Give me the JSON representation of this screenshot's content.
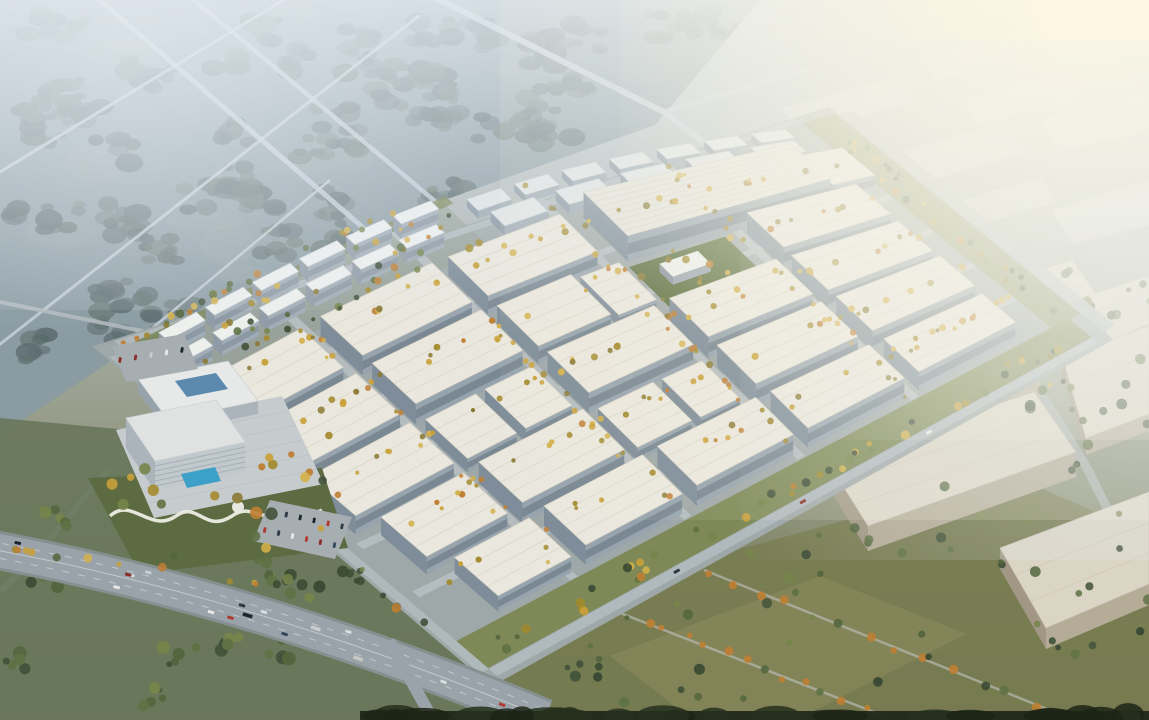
{
  "meta": {
    "description": "Aerial architectural rendering of a large industrial logistics park: grid of white warehouses with tree-lined streets, residential slab blocks and hotel amenity zone at the west, misty forest with country roads to the north-west, hazy distant warehouse district to the north-east, olive fields, scattered woods and a highway in the foreground",
    "lighting": "hazy daylight, sun glow from upper right"
  },
  "palette": {
    "sky_stops": [
      [
        0,
        "#c1cbd2"
      ],
      [
        0.3,
        "#afb7b6"
      ],
      [
        0.55,
        "#9ba190"
      ],
      [
        0.75,
        "#84896c"
      ],
      [
        1,
        "#6f7557"
      ]
    ],
    "forest_base": "#7b8d94",
    "forest_tree": [
      "#44565a",
      "#3f5154",
      "#51635f",
      "#5a6c63",
      "#4b5d5c"
    ],
    "meadow": "#8d9c94",
    "distant_road": "#c5cfd7",
    "road": "#b4bcc0",
    "boundary_road": "#b0b9bd",
    "campus_ground": "#9fa8a8",
    "residential_ground": "#96a096",
    "roof": "#eae7de",
    "roof_ridge": "#d5d1c3",
    "wall_se": "#97a4ae",
    "wall_sw": "#7e8d99",
    "window_band": "#5d6b78",
    "workshop_roof": "#e0e4e4",
    "workshop_se": "#9aa7b0",
    "workshop_sw": "#8694a0",
    "res_roof": "#eef0ee",
    "res_se": "#a0acb6",
    "res_sw": "#8e9aa6",
    "res_band": "#77838f",
    "factory_roof": "#e7e4da",
    "beige_roof": "#dbd5c6",
    "beige_se": "#b5ac98",
    "beige_sw": "#a19784",
    "lawn": "#5d6f3f",
    "green_strip": "#7a854e",
    "green_strip2": "#848d56",
    "tree_autumn": [
      "#c9a13a",
      "#bf7e33",
      "#a38b2f",
      "#8a7a33",
      "#d3b04a"
    ],
    "tree_green": [
      "#41523a",
      "#54663e",
      "#5f7244",
      "#3a4a33",
      "#76854a"
    ],
    "field_left": "#68775b",
    "field_right": "#787b4f",
    "field_right_light": "#8b8b5c",
    "highway": "#9aa3a9",
    "highway_edge": "#859091",
    "lane": "#d6dbde",
    "plaza": "#c6cbcd",
    "hotel_lawn": "#5c6b41",
    "pool": "#3da0c8",
    "path_white": "#eceee6",
    "hall_roof": "#e6e9e8",
    "hall_skylight": "#4d7fa8",
    "tower_se": "#c2c9cd",
    "tower_sw": "#aab4ba",
    "tower_band": "#9fa9b0",
    "tower_roof": "#dfe2e1",
    "parking": "#a7aeb2",
    "dark_edge": "#1c2416",
    "dark_edge2": "#26301d",
    "glow": "#fff8e2",
    "haze": "#e4ebf1",
    "car_colors": [
      "#d8dcde",
      "#2e3a46",
      "#b03a30",
      "#e8e8e8",
      "#1d252e",
      "#c7ccd0",
      "#8a2f28",
      "#33475c",
      "#c8c8c2"
    ]
  },
  "projection": {
    "c00": [
      140,
      355
    ],
    "c10": [
      810,
      130
    ],
    "c01": [
      480,
      645
    ],
    "c11": [
      1060,
      335
    ],
    "bulge": 45
  },
  "campus": {
    "u_roads": [
      0.148,
      0.315,
      0.48,
      0.645,
      0.81
    ],
    "v_roads": [
      0.175,
      0.37,
      0.565,
      0.76
    ],
    "road_width_u": 0.02,
    "road_width_v": 0.013,
    "warehouses": [
      [
        0.005,
        0.165,
        0.16,
        0.295,
        18
      ],
      [
        0.19,
        0.165,
        0.36,
        0.295,
        20
      ],
      [
        0.385,
        0.165,
        0.555,
        0.295,
        19
      ],
      [
        0.005,
        0.325,
        0.165,
        0.46,
        19
      ],
      [
        0.19,
        0.325,
        0.36,
        0.46,
        21
      ],
      [
        0.385,
        0.325,
        0.5,
        0.46,
        18
      ],
      [
        0.515,
        0.325,
        0.575,
        0.455,
        12
      ],
      [
        0.775,
        0.325,
        0.945,
        0.46,
        21
      ],
      [
        0.005,
        0.49,
        0.165,
        0.625,
        19
      ],
      [
        0.19,
        0.49,
        0.27,
        0.62,
        14
      ],
      [
        0.285,
        0.49,
        0.36,
        0.62,
        14
      ],
      [
        0.385,
        0.49,
        0.555,
        0.625,
        21
      ],
      [
        0.58,
        0.49,
        0.75,
        0.625,
        22
      ],
      [
        0.775,
        0.49,
        0.945,
        0.625,
        20
      ],
      [
        0.03,
        0.655,
        0.165,
        0.79,
        18
      ],
      [
        0.19,
        0.655,
        0.36,
        0.79,
        21
      ],
      [
        0.385,
        0.655,
        0.475,
        0.785,
        14
      ],
      [
        0.49,
        0.655,
        0.555,
        0.785,
        13
      ],
      [
        0.58,
        0.655,
        0.75,
        0.79,
        22
      ],
      [
        0.775,
        0.655,
        0.945,
        0.79,
        21
      ],
      [
        0.06,
        0.82,
        0.185,
        0.95,
        16
      ],
      [
        0.21,
        0.82,
        0.375,
        0.95,
        20
      ],
      [
        0.4,
        0.82,
        0.565,
        0.95,
        21
      ],
      [
        0.59,
        0.82,
        0.755,
        0.95,
        20
      ],
      [
        0.78,
        0.82,
        0.945,
        0.95,
        19
      ]
    ],
    "factory": [
      0.6,
      0.145,
      0.915,
      0.3,
      26
    ],
    "factory_annex": [
      0.925,
      0.155,
      0.99,
      0.285,
      15
    ],
    "workshops_r1": {
      "v0": 0.018,
      "dv": 0.038,
      "h": 8,
      "u0": 0.48,
      "du": 0.05,
      "gap": 0.021,
      "n": 7
    },
    "workshops_r2": {
      "v0": 0.075,
      "dv": 0.048,
      "h": 10,
      "u0": 0.49,
      "du": 0.065,
      "gap": 0.033,
      "n": 5
    },
    "residential_r1": {
      "v0": 0.006,
      "dv": 0.027,
      "h": 15,
      "u0": 0.025,
      "du": 0.056,
      "gap": 0.014,
      "n": 6
    },
    "residential_r2": {
      "v0": 0.068,
      "dv": 0.027,
      "h": 15,
      "u0": 0.005,
      "du": 0.056,
      "gap": 0.014,
      "n": 6
    },
    "lawn": [
      0.595,
      0.315,
      0.745,
      0.455
    ],
    "lawn_building": [
      0.625,
      0.355,
      0.685,
      0.402,
      8
    ]
  },
  "hotel": {
    "plaza": [
      [
        116,
        430
      ],
      [
        282,
        396
      ],
      [
        324,
        484
      ],
      [
        154,
        518
      ]
    ],
    "lawn": [
      [
        88,
        478
      ],
      [
        322,
        468
      ],
      [
        348,
        548
      ],
      [
        140,
        574
      ]
    ],
    "hall_roof": [
      [
        138,
        379
      ],
      [
        228,
        361
      ],
      [
        258,
        401
      ],
      [
        168,
        420
      ]
    ],
    "hall_h": 13,
    "skylight": [
      [
        175,
        381
      ],
      [
        216,
        373
      ],
      [
        228,
        389
      ],
      [
        187,
        397
      ]
    ],
    "tower_roof": [
      [
        126,
        418
      ],
      [
        216,
        400
      ],
      [
        245,
        442
      ],
      [
        155,
        461
      ]
    ],
    "tower_h": 30,
    "pool": [
      [
        181,
        474
      ],
      [
        215,
        467
      ],
      [
        221,
        481
      ],
      [
        187,
        488
      ]
    ],
    "path_d": "M110,516 C132,496 150,534 176,516 C198,500 204,534 232,516 C252,502 258,524 284,512 C300,505 312,516 322,510",
    "dome": [
      238,
      507,
      6
    ],
    "parking": [
      [
        270,
        500
      ],
      [
        352,
        517
      ],
      [
        335,
        559
      ],
      [
        253,
        541
      ]
    ],
    "nw_parking": [
      [
        112,
        346
      ],
      [
        184,
        334
      ],
      [
        198,
        369
      ],
      [
        126,
        382
      ]
    ]
  },
  "forest": {
    "poly": [
      [
        0,
        0
      ],
      [
        760,
        0
      ],
      [
        655,
        125
      ],
      [
        430,
        205
      ],
      [
        150,
        335
      ],
      [
        0,
        435
      ]
    ],
    "clusters": 60,
    "meadows": 26,
    "roads": [
      [
        [
          88,
          -10
        ],
        [
          470,
          320
        ],
        5
      ],
      [
        [
          182,
          -10
        ],
        [
          575,
          318
        ],
        4.5
      ],
      [
        [
          -10,
          178
        ],
        [
          300,
          -10
        ],
        3
      ],
      [
        [
          -10,
          352
        ],
        [
          420,
          15
        ],
        3
      ],
      [
        [
          30,
          430
        ],
        [
          330,
          180
        ],
        2.5
      ]
    ]
  },
  "top_roads": {
    "diag": [
      [
        424,
        -8
      ],
      [
        664,
        112
      ],
      [
        740,
        170
      ]
    ],
    "cont": [
      [
        664,
        112
      ],
      [
        918,
        36
      ]
    ],
    "west_links": [
      [
        [
          0,
          302
        ],
        [
          152,
          333
        ],
        4
      ],
      [
        [
          108,
          470
        ],
        [
          30,
          562
        ],
        6
      ],
      [
        [
          30,
          562
        ],
        [
          0,
          592
        ],
        6
      ]
    ]
  },
  "outer_road_d": "M868,172 Q1008,330 1088,470 Q1122,540 1149,577",
  "far_boxes": [
    {
      "p": [
        [
          782,
          108
        ],
        [
          898,
          76
        ],
        [
          918,
          100
        ],
        [
          802,
          134
        ]
      ],
      "o": 0.5
    },
    {
      "p": [
        [
          920,
          58
        ],
        [
          1018,
          32
        ],
        [
          1034,
          52
        ],
        [
          936,
          80
        ]
      ],
      "o": 0.45
    },
    {
      "p": [
        [
          960,
          100
        ],
        [
          1065,
          72
        ],
        [
          1082,
          96
        ],
        [
          977,
          126
        ]
      ],
      "o": 0.5
    },
    {
      "p": [
        [
          872,
          160
        ],
        [
          1006,
          122
        ],
        [
          1026,
          152
        ],
        [
          892,
          192
        ]
      ],
      "o": 0.55
    },
    {
      "p": [
        [
          1040,
          120
        ],
        [
          1148,
          92
        ],
        [
          1149,
          130
        ],
        [
          1058,
          152
        ]
      ],
      "o": 0.5
    },
    {
      "p": [
        [
          1052,
          210
        ],
        [
          1149,
          180
        ],
        [
          1149,
          225
        ],
        [
          1072,
          244
        ]
      ],
      "o": 0.55
    },
    {
      "p": [
        [
          945,
          205
        ],
        [
          1040,
          178
        ],
        [
          1056,
          202
        ],
        [
          961,
          230
        ]
      ],
      "o": 0.5
    }
  ],
  "outer_warehouses": [
    {
      "r": [
        [
          955,
          298
        ],
        [
          1072,
          260
        ],
        [
          1096,
          294
        ],
        [
          979,
          334
        ]
      ],
      "h": 15
    },
    {
      "r": [
        [
          1088,
          296
        ],
        [
          1149,
          276
        ],
        [
          1149,
          324
        ],
        [
          1110,
          340
        ]
      ],
      "h": 13
    },
    {
      "r": [
        [
          898,
          382
        ],
        [
          1014,
          344
        ],
        [
          1040,
          380
        ],
        [
          924,
          420
        ]
      ],
      "h": 15
    },
    {
      "r": [
        [
          1062,
          356
        ],
        [
          1149,
          326
        ],
        [
          1149,
          414
        ],
        [
          1086,
          438
        ]
      ],
      "h": 17
    },
    {
      "r": [
        [
          828,
          462
        ],
        [
          1034,
          392
        ],
        [
          1076,
          452
        ],
        [
          868,
          526
        ]
      ],
      "h": 25
    },
    {
      "r": [
        [
          1000,
          548
        ],
        [
          1149,
          492
        ],
        [
          1149,
          584
        ],
        [
          1046,
          628
        ]
      ],
      "h": 21
    }
  ],
  "fields": {
    "left_poly": [
      [
        0,
        418
      ],
      [
        150,
        432
      ],
      [
        330,
        540
      ],
      [
        520,
        628
      ],
      [
        700,
        678
      ],
      [
        700,
        720
      ],
      [
        0,
        720
      ]
    ],
    "left_clusters": 26,
    "right_poly": [
      [
        470,
        650
      ],
      [
        700,
        560
      ],
      [
        1010,
        475
      ],
      [
        1149,
        535
      ],
      [
        1149,
        720
      ],
      [
        520,
        720
      ]
    ],
    "right_light": [
      [
        610,
        656
      ],
      [
        820,
        576
      ],
      [
        966,
        634
      ],
      [
        800,
        718
      ],
      [
        690,
        718
      ]
    ],
    "right_singles": 40,
    "tree_lines": [
      [
        [
          587,
          600
        ],
        [
          884,
          716
        ],
        16
      ],
      [
        [
          704,
          570
        ],
        [
          1064,
          716
        ],
        14
      ]
    ]
  },
  "highway": {
    "p0": [
      -15,
      548
    ],
    "p1": [
      255,
      597
    ],
    "p2": [
      545,
      718
    ],
    "width": 33,
    "edge_width": 39,
    "lanes": [
      -11,
      -4,
      4,
      11
    ],
    "n_cars": 16,
    "branch": [
      [
        389,
        641
      ],
      [
        433,
        720
      ]
    ]
  },
  "bottom_edge": {
    "x0": 360,
    "x1": 1149,
    "y": 711,
    "blobs": 26
  },
  "seed": 11
}
